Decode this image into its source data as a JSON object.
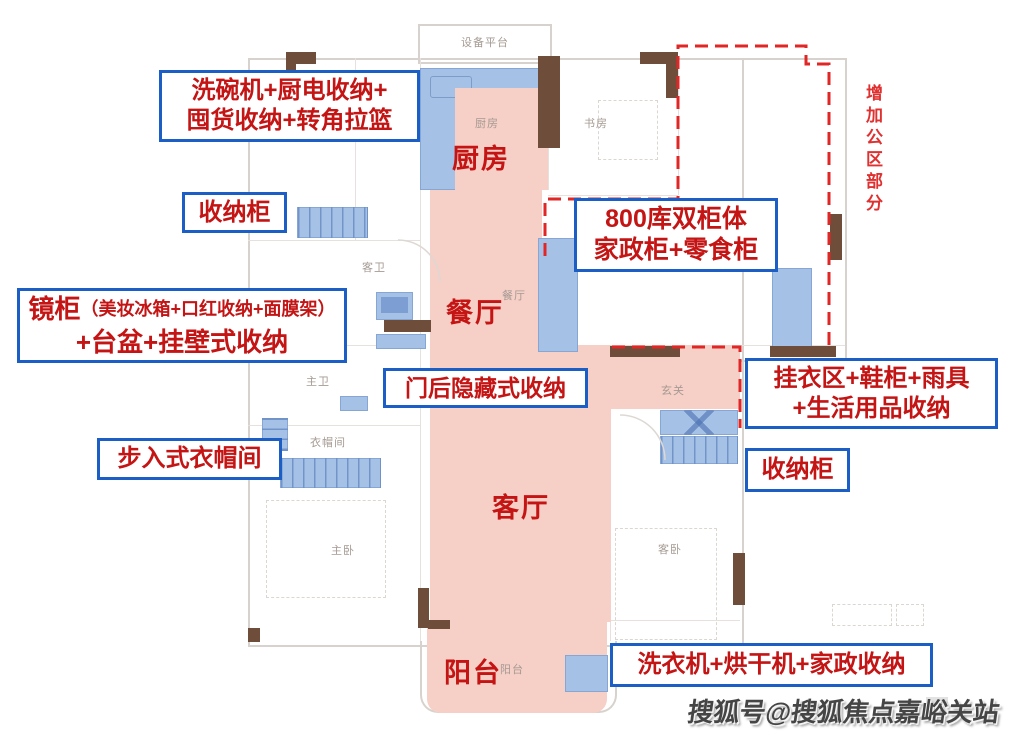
{
  "annotations": {
    "kitchen_storage": {
      "line1": "洗碗机+厨电收纳+",
      "line2": "囤货收纳+转角拉篮"
    },
    "storage_cabinet_left": {
      "label": "收纳柜"
    },
    "mirror_cabinet": {
      "title": "镜柜",
      "detail": "（美妆冰箱+口红收纳+面膜架）",
      "line2": "+台盆+挂壁式收纳"
    },
    "behind_door": {
      "label": "门后隐藏式收纳"
    },
    "walkin_closet": {
      "label": "步入式衣帽间"
    },
    "pantry": {
      "line1": "800库双柜体",
      "line2": "家政柜+零食柜"
    },
    "entry_storage": {
      "line1": "挂衣区+鞋柜+雨具",
      "line2": "+生活用品收纳"
    },
    "storage_cabinet_right": {
      "label": "收纳柜"
    },
    "laundry": {
      "label": "洗衣机+烘干机+家政收纳"
    },
    "public_area_note": {
      "label": "增加公区部分"
    }
  },
  "highlight_labels": {
    "kitchen": "厨房",
    "dining": "餐厅",
    "living": "客厅",
    "balcony": "阳台"
  },
  "plan_labels": {
    "equipment_platform": "设备平台",
    "kitchen": "厨房",
    "study": "书房",
    "guest_bathroom": "客卫",
    "dining": "餐厅",
    "master_bathroom": "主卫",
    "entry": "玄关",
    "cloakroom": "衣帽间",
    "master_bedroom": "主卧",
    "guest_bedroom": "客卧",
    "balcony": "阳台"
  },
  "watermark": {
    "text": "搜狐号@搜狐焦点嘉峪关站"
  },
  "colors": {
    "annotation_red": "#c41414",
    "box_border_blue": "#1b5ec6",
    "dashed_red": "#e12626",
    "pink_overlay": "#f6cfc6",
    "blue_overlay": "#a5c1e6",
    "wall_brown": "#6e4e3b",
    "note_red": "#e03030"
  }
}
